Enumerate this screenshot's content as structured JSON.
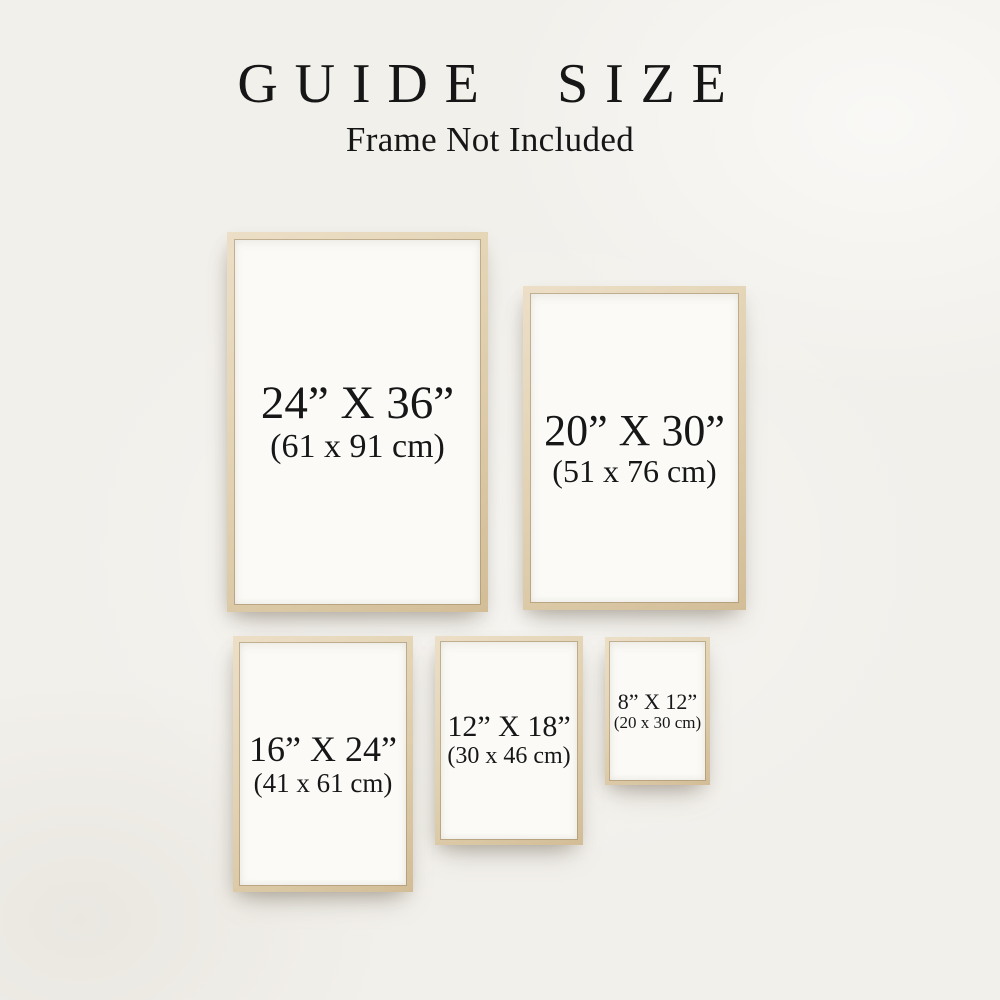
{
  "header": {
    "title": "GUIDE SIZE",
    "subtitle": "Frame Not Included"
  },
  "frames": [
    {
      "name": "24x36",
      "inches": "24” X 36”",
      "centimeters": "(61 x 91 cm)"
    },
    {
      "name": "20x30",
      "inches": "20” X 30”",
      "centimeters": "(51 x 76 cm)"
    },
    {
      "name": "16x24",
      "inches": "16” X 24”",
      "centimeters": "(41 x 61 cm)"
    },
    {
      "name": "12x18",
      "inches": "12” X 18”",
      "centimeters": "(30 x 46 cm)"
    },
    {
      "name": "8x12",
      "inches": "8” X 12”",
      "centimeters": "(20 x 30 cm)"
    }
  ],
  "colors": {
    "background": "#f2f0eb",
    "frame_wood": "#e2d2b2",
    "paper": "#fbfaf6",
    "text": "#171717"
  }
}
